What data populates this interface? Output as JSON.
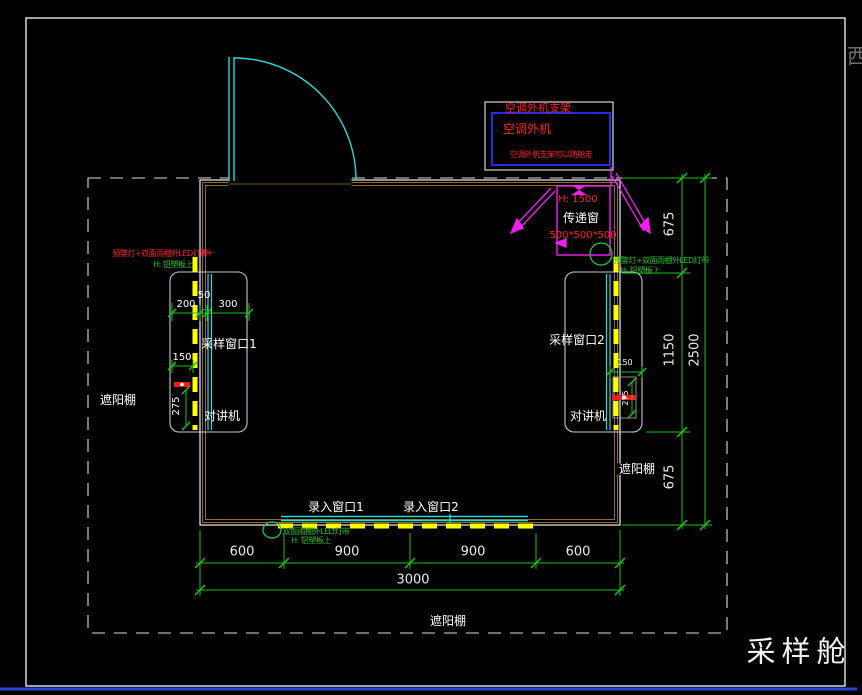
{
  "frame": {
    "compass": "西",
    "title": "采样舱"
  },
  "ac": {
    "bracket": "空调外机支架",
    "unit": "空调外机",
    "note": "空调外机支架可以随舱走"
  },
  "transfer": {
    "h": "H: 1500",
    "name": "传递窗",
    "size": "500*500*500"
  },
  "left": {
    "window": "采样窗口1",
    "intercom": "对讲机",
    "canopy": "遮阳棚",
    "d200": "200",
    "d50": "50",
    "d300": "300",
    "d150": "150",
    "d275": "275",
    "note1": "预警灯+双面雨棚外LED灯带",
    "note2": "H: 铝塑板上",
    "mark": "2+"
  },
  "right": {
    "window": "采样窗口2",
    "intercom": "对讲机",
    "canopy": "遮阳棚",
    "d150": "150",
    "d275": "275",
    "note1": "预警灯+双面雨棚外LED灯带",
    "note2": "H: 铝塑板上"
  },
  "bottom": {
    "entry1": "录入窗口1",
    "entry2": "录入窗口2",
    "canopy": "遮阳棚",
    "note1": "双面雨棚外LED灯带",
    "note2": "H: 铝塑板上",
    "d600a": "600",
    "d900a": "900",
    "d900b": "900",
    "d600b": "600",
    "d3000": "3000"
  },
  "rightdims": {
    "d675a": "675",
    "d1150": "1150",
    "d675b": "675",
    "d2500": "2500"
  },
  "colors": {
    "green": "#17c417",
    "yellow": "#ffff00",
    "magenta": "#f21ef2",
    "red": "#ff1a1a",
    "cyan": "#2bd8d8",
    "wall": "#8a6b2f",
    "blue": "#2a46d6"
  }
}
